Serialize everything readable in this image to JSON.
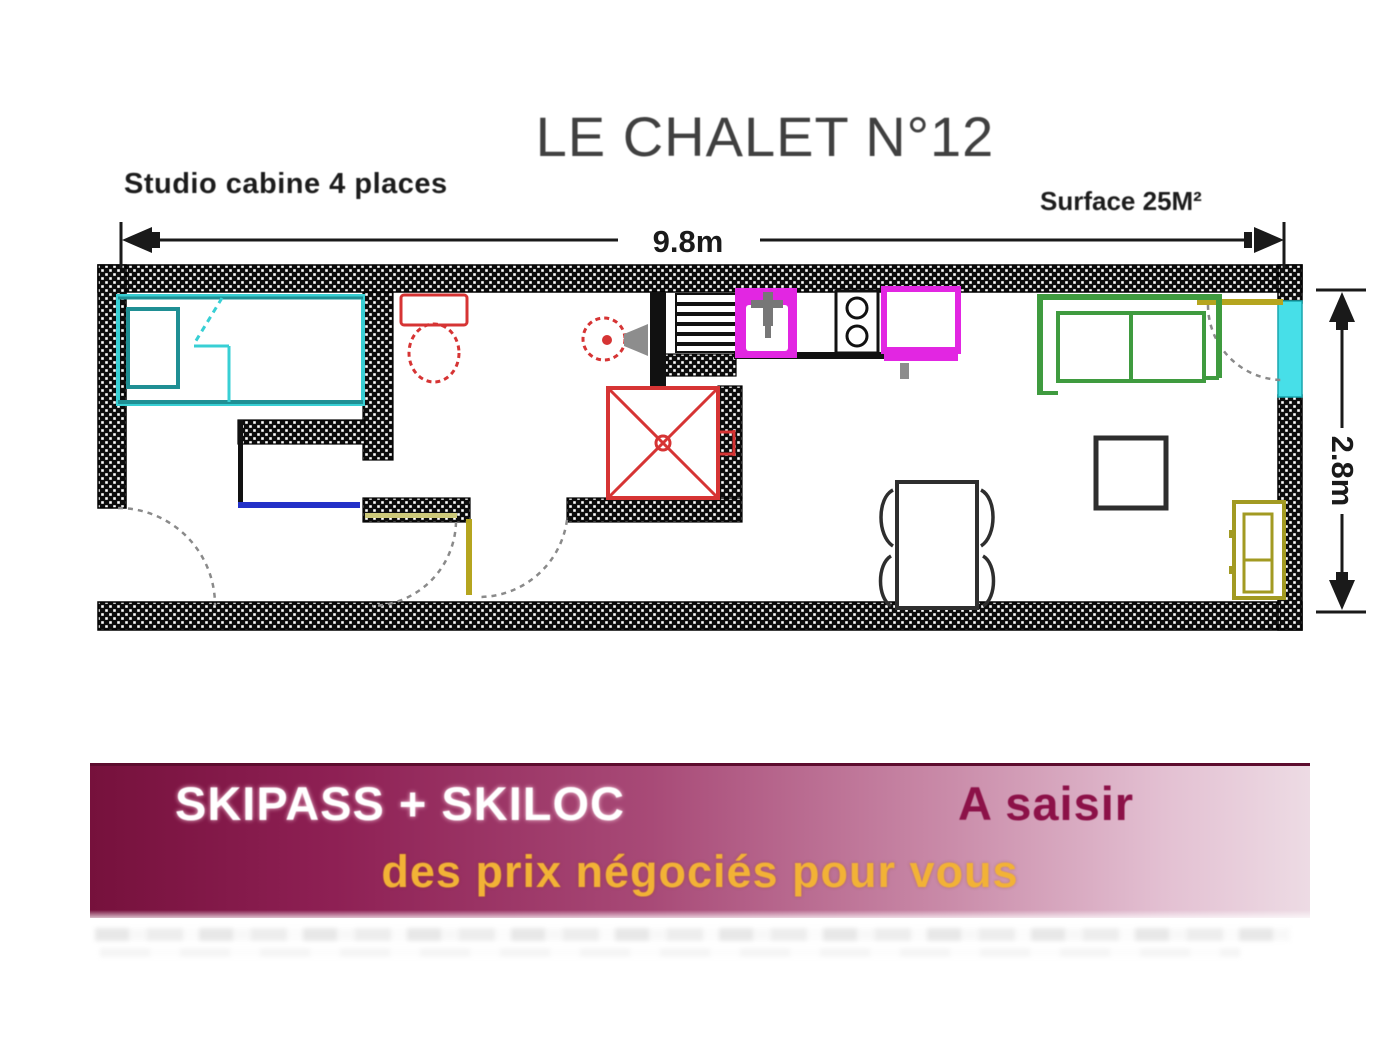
{
  "title": "LE CHALET N°12",
  "plan": {
    "type_label": "Studio cabine 4 places",
    "surface_label": "Surface 25M²",
    "width_label": "9.8m",
    "height_label": "2.8m",
    "colors": {
      "wall": "#0d0d0d",
      "bed_cyan": "#38cfd4",
      "bed_teal": "#1f8f94",
      "sanitary_red": "#d63434",
      "kitchen_magenta": "#e226e2",
      "sofa_green": "#3f9b3f",
      "cabinet_olive": "#a29a22",
      "window_cyan": "#47dfe8",
      "closet_blue": "#2331c8",
      "door_yellow": "#b5a51f",
      "swing_gray": "#8a8a8a"
    }
  },
  "banner": {
    "line1_left": "SKIPASS + SKILOC",
    "line1_right": "A saisir",
    "line2": "des prix négociés pour vous",
    "colors": {
      "gradient_from": "#76113c",
      "gradient_to": "#eddbe4",
      "accent": "#8c1148",
      "line2_color": "#f2b236"
    }
  }
}
